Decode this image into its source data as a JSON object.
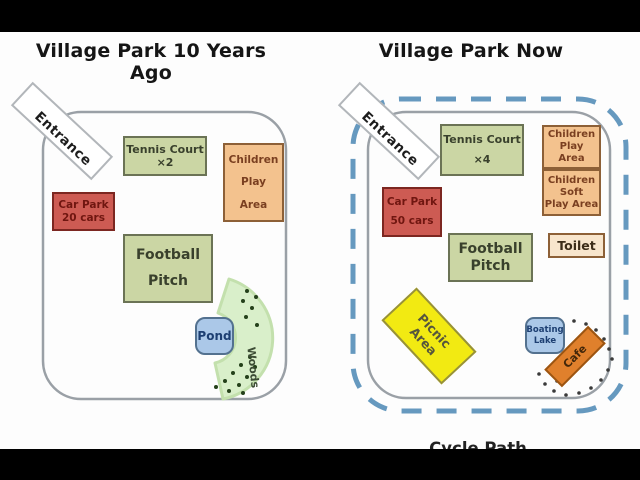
{
  "left_map": {
    "title": "Village Park 10 Years Ago",
    "entrance_label": "Entrance",
    "tennis": {
      "line1": "Tennis Court",
      "line2": "×2"
    },
    "children_play": {
      "line1": "Children",
      "line2": "Play",
      "line3": "Area"
    },
    "car_park": {
      "line1": "Car Park",
      "line2": "20 cars"
    },
    "football": {
      "line1": "Football",
      "line2": "Pitch"
    },
    "pond_label": "Pond",
    "woods_label": "Woods"
  },
  "right_map": {
    "title": "Village Park Now",
    "entrance_label": "Entrance",
    "tennis": {
      "line1": "Tennis Court",
      "line2": "×4"
    },
    "children_play": {
      "line1": "Children",
      "line2": "Play",
      "line3": "Area"
    },
    "children_soft_play": {
      "line1": "Children",
      "line2": "Soft",
      "line3": "Play Area"
    },
    "car_park": {
      "line1": "Car Park",
      "line2": "50 cars"
    },
    "football": {
      "line1": "Football",
      "line2": "Pitch"
    },
    "toilet_label": "Toilet",
    "picnic": {
      "line1": "Picnic",
      "line2": "Area"
    },
    "boating_lake": {
      "line1": "Boating",
      "line2": "Lake"
    },
    "cafe_label": "Cafe",
    "cycle_path_label": "Cycle Path"
  },
  "colors": {
    "facility_green": "#cbd6a4",
    "facility_orange": "#f3c28e",
    "car_park_red": "#cd5b53",
    "toilet_cream": "#f8e5cc",
    "water_blue": "#abc8e8",
    "picnic_yellow": "#f2ea12",
    "cafe_orange": "#e0802c",
    "woods_green": "#d9efca",
    "boundary_gray": "#9aa0a6",
    "cycle_path_blue": "#6699bf",
    "letterbox_black": "#000000"
  }
}
